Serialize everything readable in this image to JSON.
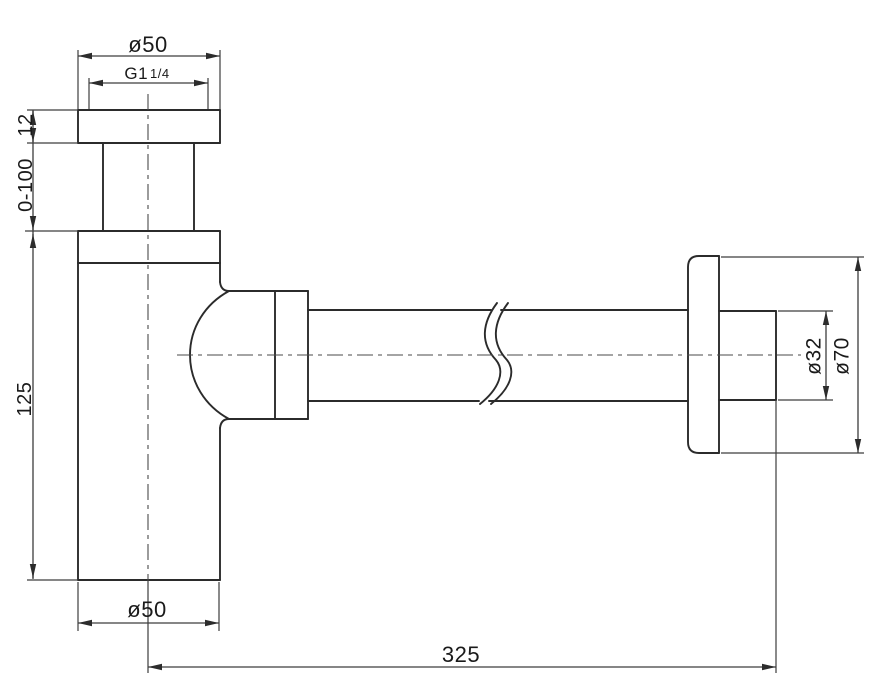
{
  "drawing": {
    "kind": "technical-dimension-drawing",
    "subject": "basin bottle trap siphon, side elevation"
  },
  "colors": {
    "background": "#ffffff",
    "outline": "#2b2b2b",
    "dimension": "#3d3d3d",
    "text": "#1a1a1a"
  },
  "labels": {
    "top_diameter": "ø50",
    "thread_main": "G1",
    "thread_fraction": "1/4",
    "flange_height": "12",
    "adjustable_range": "0-100",
    "body_height": "125",
    "bottom_diameter": "ø50",
    "overall_length": "325",
    "pipe_diameter": "ø32",
    "wall_flange_diameter": "ø70"
  }
}
